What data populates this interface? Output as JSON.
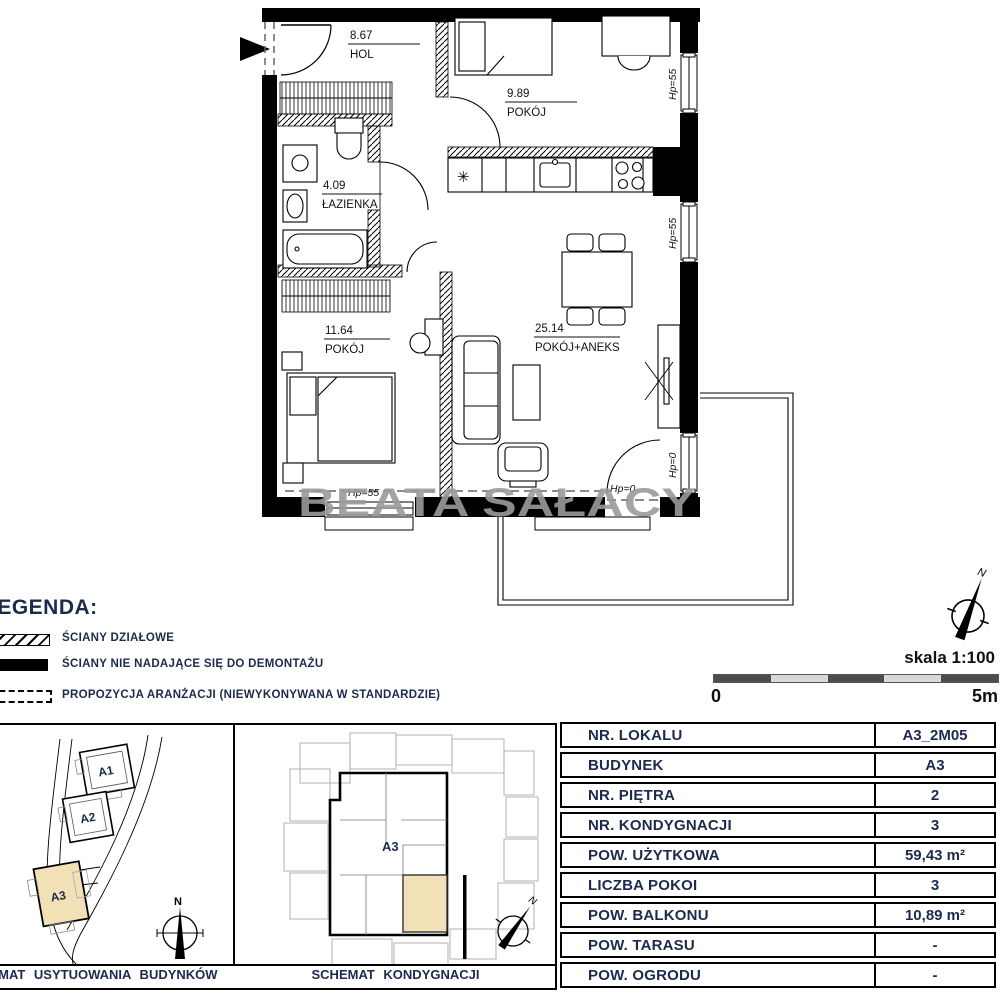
{
  "colors": {
    "navy": "#1c2a4d",
    "beige": "#f2e1b6",
    "watermark_gray": "#9b9b9b"
  },
  "floor_plan": {
    "rooms": [
      {
        "area": "8.67",
        "name": "HOL"
      },
      {
        "area": "9.89",
        "name": "POKÓJ"
      },
      {
        "area": "4.09",
        "name": "ŁAZIENKA"
      },
      {
        "area": "11.64",
        "name": "POKÓJ"
      },
      {
        "area": "25.14",
        "name": "POKÓJ+ANEKS"
      }
    ],
    "window_labels": {
      "right_top": "Hp=55",
      "right_mid": "Hp=55",
      "right_bottom": "Hp=0",
      "bottom_left": "Hp=55",
      "bottom_right": "Hp=0"
    },
    "watermark": "BEATA SAŁACY"
  },
  "legend": {
    "title": "LEGENDA:",
    "items": [
      {
        "label": "ŚCIANY DZIAŁOWE",
        "swatch": "hatched"
      },
      {
        "label": "ŚCIANY NIE NADAJĄCE SIĘ DO DEMONTAŻU",
        "swatch": "solid"
      },
      {
        "label": "PROPOZYCJA ARANŻACJI (NIEWYKONYWANA W STANDARDZIE)",
        "swatch": "dashed"
      }
    ]
  },
  "scale": {
    "label": "skala 1:100",
    "start": "0",
    "end": "5m"
  },
  "compass": {
    "north": "N"
  },
  "site_plan": {
    "buildings": [
      "A1",
      "A2",
      "A3"
    ],
    "highlighted": "A3",
    "caption": "SCHEMAT USYTUOWANIA BUDYNKÓW"
  },
  "floor_schematic": {
    "building_label": "A3",
    "caption": "SCHEMAT KONDYGNACJI"
  },
  "unit_table": {
    "rows": [
      {
        "label": "NR. LOKALU",
        "value": "A3_2M05"
      },
      {
        "label": "BUDYNEK",
        "value": "A3"
      },
      {
        "label": "NR. PIĘTRA",
        "value": "2"
      },
      {
        "label": "NR. KONDYGNACJI",
        "value": "3"
      },
      {
        "label": "POW. UŻYTKOWA",
        "value": "59,43 m²"
      },
      {
        "label": "LICZBA POKOI",
        "value": "3"
      },
      {
        "label": "POW. BALKONU",
        "value": "10,89 m²"
      },
      {
        "label": "POW. TARASU",
        "value": "-"
      },
      {
        "label": "POW. OGRODU",
        "value": "-"
      }
    ]
  }
}
